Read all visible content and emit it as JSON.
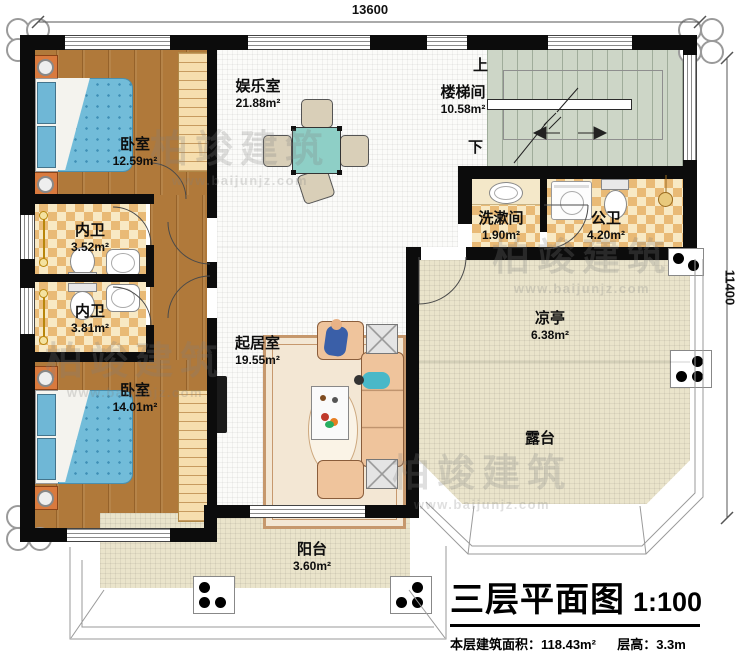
{
  "meta": {
    "title": "三层平面图",
    "scale": "1:100",
    "area_label": "本层建筑面积：",
    "area_value": "118.43m²",
    "height_label": "层高：",
    "height_value": "3.3m"
  },
  "dimensions": {
    "width": "13600",
    "height": "11400"
  },
  "stairs": {
    "up": "上",
    "down": "下"
  },
  "watermark": {
    "name": "柏竣建筑",
    "url": "www.baijunjz.com"
  },
  "rooms": [
    {
      "id": "bedroom-top",
      "name": "卧室",
      "area": "12.59m²"
    },
    {
      "id": "entertainment",
      "name": "娱乐室",
      "area": "21.88m²"
    },
    {
      "id": "stairwell",
      "name": "楼梯间",
      "area": "10.58m²"
    },
    {
      "id": "bath-inner-1",
      "name": "内卫",
      "area": "3.52m²"
    },
    {
      "id": "bath-inner-2",
      "name": "内卫",
      "area": "3.81m²"
    },
    {
      "id": "bedroom-bottom",
      "name": "卧室",
      "area": "14.01m²"
    },
    {
      "id": "living",
      "name": "起居室",
      "area": "19.55m²"
    },
    {
      "id": "washroom",
      "name": "洗漱间",
      "area": "1.90m²"
    },
    {
      "id": "public-bath",
      "name": "公卫",
      "area": "4.20m²"
    },
    {
      "id": "pavilion",
      "name": "凉亭",
      "area": "6.38m²"
    },
    {
      "id": "terrace",
      "name": "露台",
      "area": ""
    },
    {
      "id": "balcony",
      "name": "阳台",
      "area": "3.60m²"
    }
  ],
  "colors": {
    "wall": "#0c0c0c",
    "wood_floor": "#b0793a",
    "tile_floor": "#e9ba76",
    "hall_floor": "#fbfbf9",
    "terrace_floor": "#eae4cb",
    "stairs_floor": "#cdd6c7",
    "bed_blue": "#72bcd9",
    "sofa_peach": "#efc49c",
    "table_teal": "#8ecfc6",
    "nightstand_orange": "#d97a3e"
  }
}
